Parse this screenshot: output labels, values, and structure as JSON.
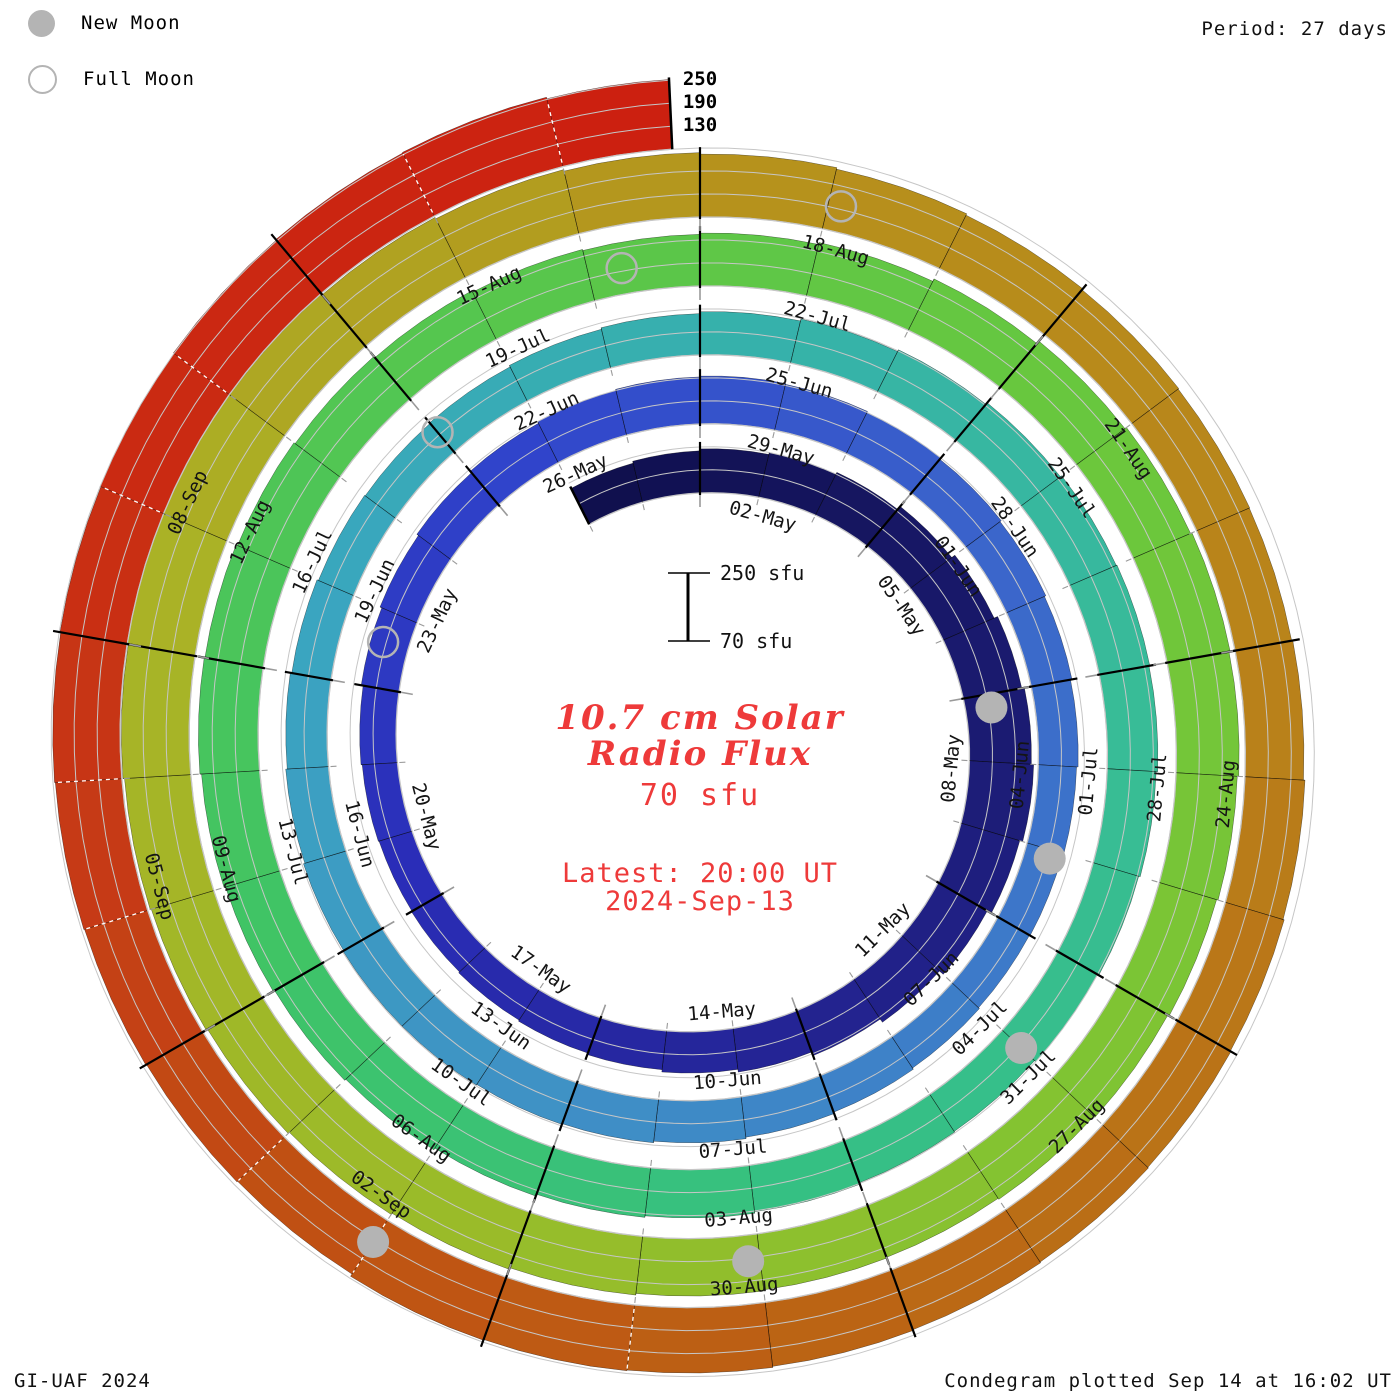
{
  "header": {
    "period_label": "Period: 27 days"
  },
  "legend": {
    "new_moon": "New Moon",
    "full_moon": "Full Moon"
  },
  "footer": {
    "left": "GI-UAF 2024",
    "right": "Condegram plotted Sep 14 at 16:02 UT"
  },
  "center": {
    "title_line1": "10.7 cm Solar",
    "title_line2": "Radio Flux",
    "baseline_label": "70 sfu",
    "latest_line1": "Latest: 20:00 UT",
    "latest_line2": "2024-Sep-13",
    "scale_top_label": "250 sfu",
    "scale_bottom_label": "70 sfu"
  },
  "chart_data": {
    "type": "spiral-bar-condegram",
    "title": "10.7 cm Solar Radio Flux",
    "rotation_period_days": 27,
    "start_date": "2024-04-30",
    "end_date": "2024-09-13",
    "latest_obs": "2024-Sep-13 20:00 UT",
    "radial_axis": {
      "baseline_sfu": 70,
      "grid_sfu": [
        130,
        190,
        250
      ],
      "grid_tick_labels": [
        "130",
        "190",
        "250"
      ],
      "unit": "sfu"
    },
    "date_labels": [
      "02-May",
      "05-May",
      "08-May",
      "11-May",
      "14-May",
      "17-May",
      "20-May",
      "23-May",
      "26-May",
      "29-May",
      "01-Jun",
      "04-Jun",
      "07-Jun",
      "10-Jun",
      "13-Jun",
      "16-Jun",
      "19-Jun",
      "22-Jun",
      "25-Jun",
      "28-Jun",
      "01-Jul",
      "04-Jul",
      "07-Jul",
      "10-Jul",
      "13-Jul",
      "16-Jul",
      "19-Jul",
      "22-Jul",
      "25-Jul",
      "28-Jul",
      "31-Jul",
      "03-Aug",
      "06-Aug",
      "09-Aug",
      "12-Aug",
      "15-Aug",
      "18-Aug",
      "21-Aug",
      "24-Aug",
      "27-Aug",
      "30-Aug",
      "02-Sep",
      "05-Sep",
      "08-Sep"
    ],
    "flux_note": "Daily F10.7 flux (sfu) from 2024-04-30 through 2024-09-13, estimated from bar heights in the plot",
    "flux_sfu": [
      175,
      180,
      185,
      190,
      195,
      205,
      215,
      225,
      232,
      238,
      230,
      218,
      205,
      195,
      185,
      178,
      172,
      168,
      165,
      162,
      160,
      162,
      165,
      170,
      175,
      180,
      185,
      190,
      193,
      195,
      193,
      190,
      186,
      182,
      178,
      174,
      170,
      167,
      165,
      168,
      172,
      176,
      180,
      184,
      186,
      188,
      188,
      186,
      182,
      178,
      174,
      170,
      168,
      170,
      174,
      178,
      183,
      188,
      193,
      198,
      202,
      204,
      202,
      198,
      194,
      190,
      186,
      188,
      192,
      196,
      200,
      205,
      210,
      214,
      218,
      222,
      226,
      224,
      220,
      216,
      212,
      208,
      205,
      208,
      213,
      220,
      228,
      233,
      237,
      234,
      230,
      226,
      222,
      218,
      215,
      217,
      220,
      224,
      228,
      232,
      236,
      240,
      243,
      247,
      250,
      252,
      249,
      246,
      242,
      238,
      234,
      230,
      226,
      223,
      221,
      220,
      223,
      227,
      230,
      232,
      234,
      236,
      238,
      241,
      243,
      245,
      238,
      240,
      242,
      244,
      246,
      248,
      250,
      252,
      254,
      256,
      252
    ],
    "moons": {
      "new_moon_day_indices": [
        8.2,
        37.1,
        66.0,
        96.1,
        126.0
      ],
      "full_moon_day_indices": [
        23.6,
        53.0,
        82.3,
        111.1
      ],
      "new_moon_dates": [
        "2024-05-08",
        "2024-06-06",
        "2024-07-05",
        "2024-08-04",
        "2024-09-03"
      ],
      "full_moon_dates": [
        "2024-05-23",
        "2024-06-22",
        "2024-07-21",
        "2024-08-19"
      ]
    },
    "layout": {
      "label_step_days": 3,
      "legend_position": "top-left",
      "grid": true,
      "clockwise_from_top": true
    },
    "colors": {
      "text_red": "#ee3a3a",
      "grid_gray": "#c6c6c6",
      "moon_gray": "#b4b4b4",
      "colormap_day_stops": [
        [
          0,
          "#10104e"
        ],
        [
          8,
          "#1b1b72"
        ],
        [
          14,
          "#242495"
        ],
        [
          20,
          "#2a2db8"
        ],
        [
          26,
          "#3044cb"
        ],
        [
          32,
          "#3a62cb"
        ],
        [
          38,
          "#3d7ac9"
        ],
        [
          44,
          "#3f92c5"
        ],
        [
          50,
          "#3aa5c0"
        ],
        [
          56,
          "#36b1ab"
        ],
        [
          62,
          "#38bc97"
        ],
        [
          68,
          "#35c083"
        ],
        [
          74,
          "#40c465"
        ],
        [
          80,
          "#55c64f"
        ],
        [
          86,
          "#68c73e"
        ],
        [
          92,
          "#7fc433"
        ],
        [
          98,
          "#9abb29"
        ],
        [
          104,
          "#aab226"
        ],
        [
          110,
          "#b6921c"
        ],
        [
          116,
          "#b9811a"
        ],
        [
          122,
          "#bb6414"
        ],
        [
          126,
          "#c05013"
        ],
        [
          129,
          "#c63a16"
        ],
        [
          132,
          "#ca2a12"
        ],
        [
          136,
          "#cc2010"
        ]
      ]
    }
  }
}
